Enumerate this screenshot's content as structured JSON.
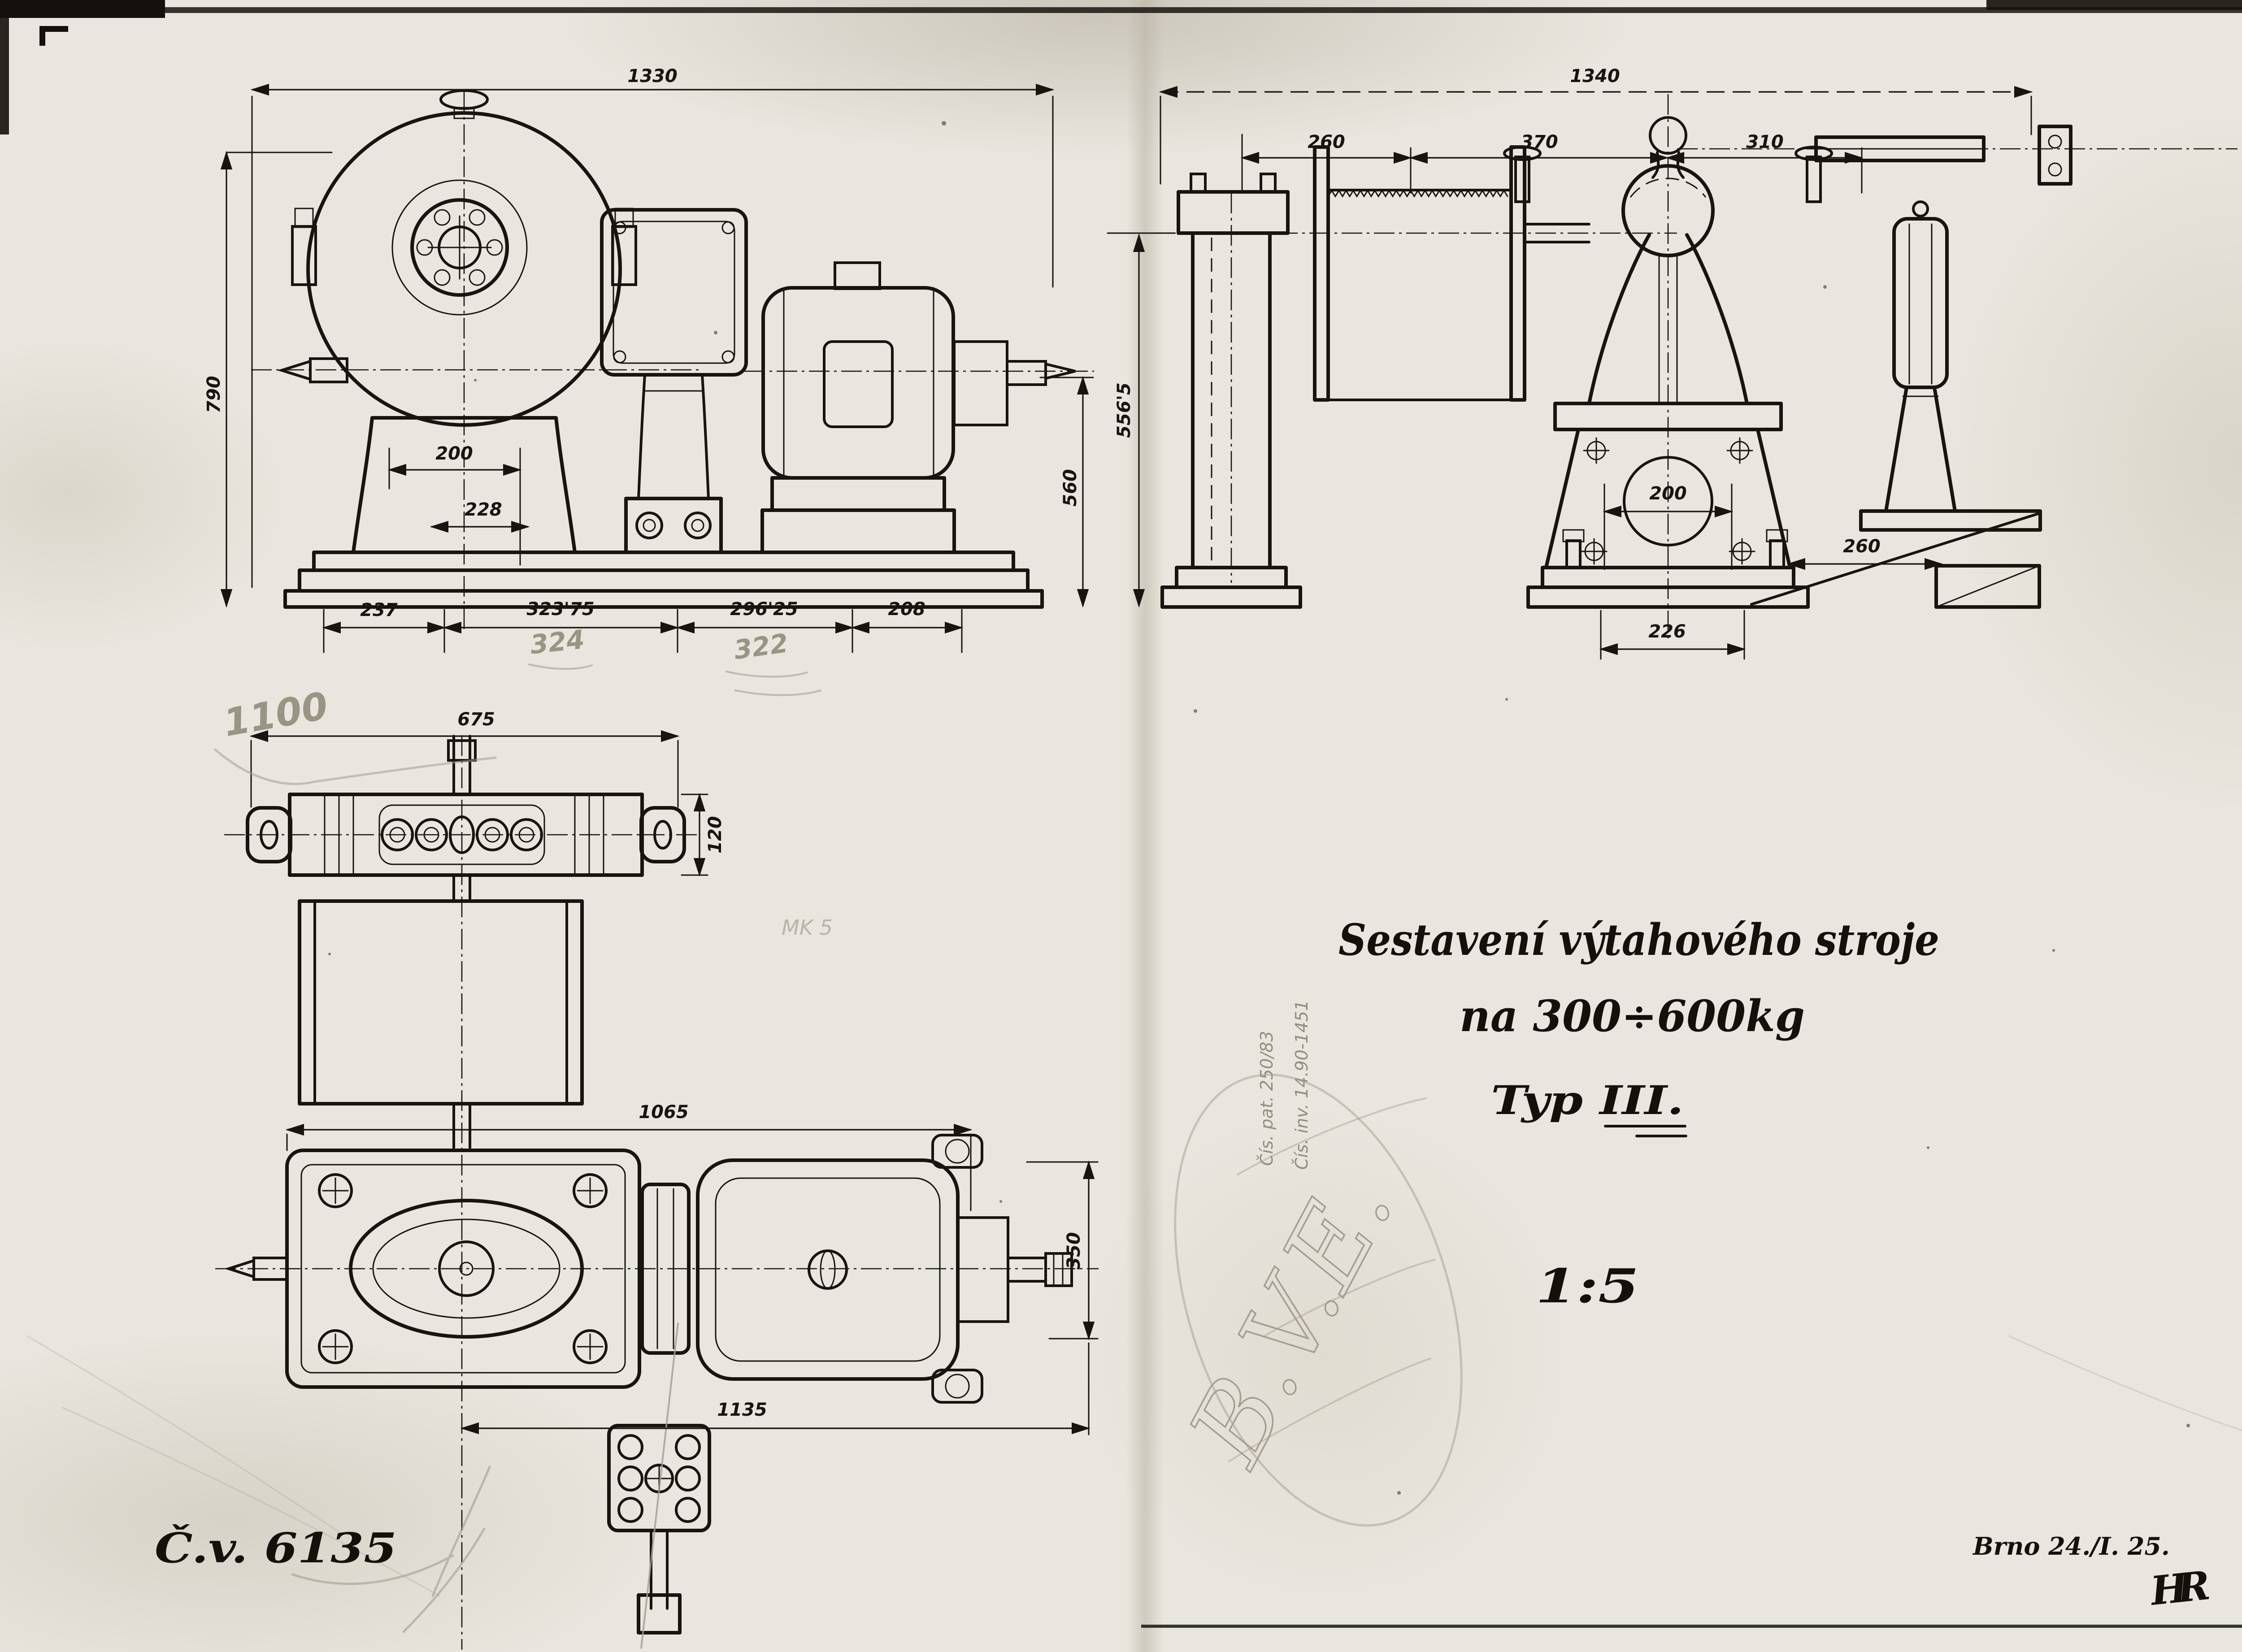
{
  "document": {
    "kind": "Scanned engineering drawing, Czech, 1925",
    "title_line1": "Sestavení výtahového stroje",
    "title_line2": "na 300÷600kg",
    "type_label": "Typ III.",
    "scale": "1:5",
    "drawing_number": "Č.v. 6135",
    "place_date": "Brno 24./I. 25.",
    "author_monogram": "HR"
  },
  "colors": {
    "paper": "#e9e6df",
    "ink": "#181510",
    "pencil": "#a39d90"
  },
  "front_view": {
    "name": "front elevation of hoisting machine",
    "dim_overall": "1330",
    "dim_height": "790",
    "dim_gear_foot": "200",
    "dim_bracket_offset": "228",
    "dim_motor_axis": "560",
    "dim_base_a": "237",
    "dim_base_b": "323'75",
    "dim_base_c": "296'25",
    "dim_base_d": "208",
    "pencil_a": "324",
    "pencil_b": "322"
  },
  "side_view": {
    "name": "side elevation with rope drum",
    "dim_overall": "1340",
    "dim_drum_width": "260",
    "dim_drum_to_axis": "370",
    "dim_axis_to_brake": "310",
    "dim_height": "556'5",
    "dim_pedestal": "200",
    "dim_bracket": "260",
    "dim_foot": "226"
  },
  "plan_view": {
    "name": "plan view of machine",
    "dim_bracket": "675",
    "dim_bracket_width": "120",
    "dim_to_motor": "1065",
    "dim_half_width": "350",
    "dim_overall": "1135",
    "pencil_span": "1100"
  },
  "pencil_annotations": {
    "inventory_1": "Čís. inv. 14.90-1451",
    "inventory_2": "Čís. pat. 250/83",
    "oval_stamp": "B.V.E.",
    "faint_note": "MK 5"
  }
}
